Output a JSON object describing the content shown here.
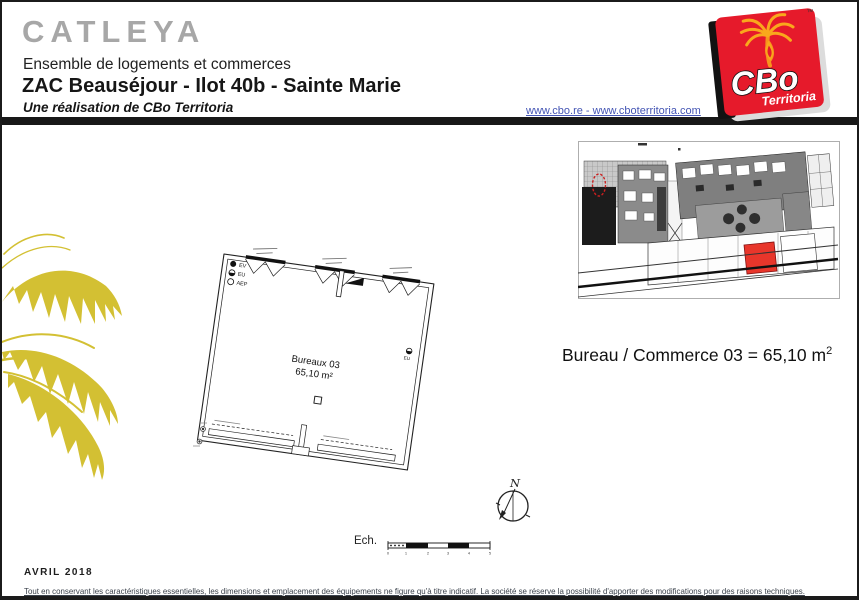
{
  "header": {
    "project_name": "CATLEYA",
    "subtitle": "Ensemble de logements et commerces",
    "location": "ZAC Beauséjour - Ilot 40b - Sainte Marie",
    "developer": "Une réalisation de CBo Territoria",
    "links": "www.cbo.re - www.cboterritoria.com"
  },
  "logo": {
    "brand": "CBo",
    "brand_sub": "Territoria",
    "trademark": "™",
    "bg_color": "#e61a2b",
    "palm_color": "#f9a81c"
  },
  "site_plan": {
    "highlight_color": "#e8362b"
  },
  "floor_plan": {
    "room_label": "Bureaux 03",
    "room_area": "65,10 m²",
    "legend": [
      {
        "symbol": "filled-circle",
        "label": "EV"
      },
      {
        "symbol": "half-filled-circle",
        "label": "EU"
      },
      {
        "symbol": "empty-circle",
        "label": "AEP"
      }
    ],
    "wall_marker_label": "EU"
  },
  "unit_summary": {
    "text": "Bureau / Commerce 03 = 65,10 m",
    "sup": "2"
  },
  "compass": {
    "north_label": "N"
  },
  "scale_bar": {
    "label": "Ech.",
    "ticks": [
      "0",
      "1",
      "2",
      "3",
      "4",
      "5"
    ]
  },
  "footer": {
    "date": "AVRIL 2018",
    "disclaimer": "Tout en conservant les caractéristiques essentielles, les dimensions et emplacement des équipements ne figure qu'à titre indicatif. La société se réserve la possibilité d'apporter des modifications pour des raisons techniques."
  },
  "colors": {
    "title_gray": "#a7a7a7",
    "link_blue": "#4455b4",
    "header_bar_black": "#181818",
    "palm_watermark_yellow": "#d3c033",
    "logo_red": "#e61a2b",
    "plan_line_black": "#222222"
  }
}
